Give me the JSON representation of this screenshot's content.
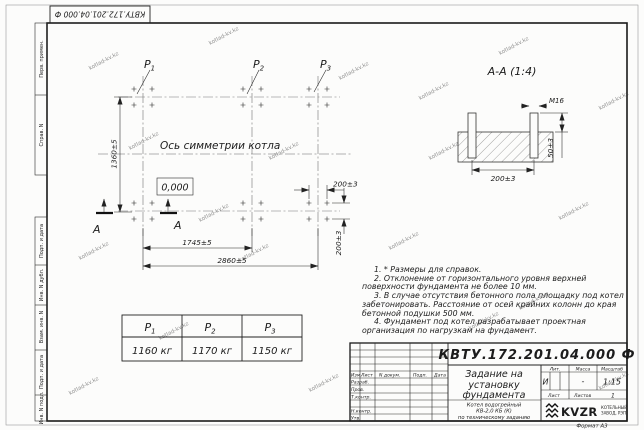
{
  "watermark": "kotlad-kv.kz",
  "frame": {
    "designation_rotated": "КВТУ.172.201.04.000  Ф",
    "strip_labels": [
      "Перв. примен.",
      "Справ. N",
      "Подп. и дата",
      "Инв. N дубл.",
      "Взам. инв. N",
      "Подп. и дата",
      "Инв. N подл."
    ]
  },
  "plan": {
    "axis_label": "Ось симметрии котла",
    "zero_mark": "0,000",
    "p_labels": [
      {
        "name": "Р",
        "sub": "1"
      },
      {
        "name": "Р",
        "sub": "2"
      },
      {
        "name": "Р",
        "sub": "3"
      }
    ],
    "dim_height": "1360±5",
    "dim_span_mid": "1745±5",
    "dim_span_full": "2860±5",
    "dim_bolt_x": "200±3",
    "dim_bolt_y": "200±3",
    "section_letter": "А"
  },
  "section": {
    "title": "А-А (1:4)",
    "thread": "М16",
    "dim_width": "200±3",
    "dim_height": "50±3"
  },
  "notes": [
    "1. * Размеры для справок.",
    "2. Отклонение от горизонтального уровня верхней поверхности фундамента не более 10 мм.",
    "3. В случае отсутствия бетонного пола площадку под котел забетонировать. Расстояние от осей крайних колонн до края бетонной подушки 500 мм.",
    "4. Фундамент под котел разрабатывает проектная организация по нагрузкам на фундамент."
  ],
  "load_table": {
    "headers": [
      {
        "name": "Р",
        "sub": "1"
      },
      {
        "name": "Р",
        "sub": "2"
      },
      {
        "name": "Р",
        "sub": "3"
      }
    ],
    "values": [
      "1160 кг",
      "1170 кг",
      "1150 кг"
    ]
  },
  "title_block": {
    "designation": "КВТУ.172.201.04.000  Ф",
    "doc_title_lines": [
      "Задание на",
      "установку",
      "фундамента"
    ],
    "product_lines": [
      "Котел водогрейный",
      "КВ-2,0 КБ (К)",
      "по техническому заданию"
    ],
    "columns": {
      "izm": "Изм.",
      "list": "Лист",
      "n_doc": "N докум.",
      "podp": "Подп.",
      "data": "Дата"
    },
    "rows": {
      "razrab": "Разраб.",
      "prov": "Пров.",
      "t_kontr": "Т.контр.",
      "n_kontr": "Н.контр.",
      "utv": "Утв."
    },
    "lit_label": "Лит.",
    "lit_value": "И",
    "massa_label": "Масса",
    "massa_value": "-",
    "masshtab_label": "Масштаб",
    "masshtab_value": "1:15",
    "list_label": "Лист",
    "listov_label": "Листов",
    "listov_value": "1",
    "logo_text": "KVZR",
    "company_lines": [
      "КОТЕЛЬНЫЙ",
      "ЗАВОД, РЭП"
    ],
    "format_label": "Формат А3"
  }
}
